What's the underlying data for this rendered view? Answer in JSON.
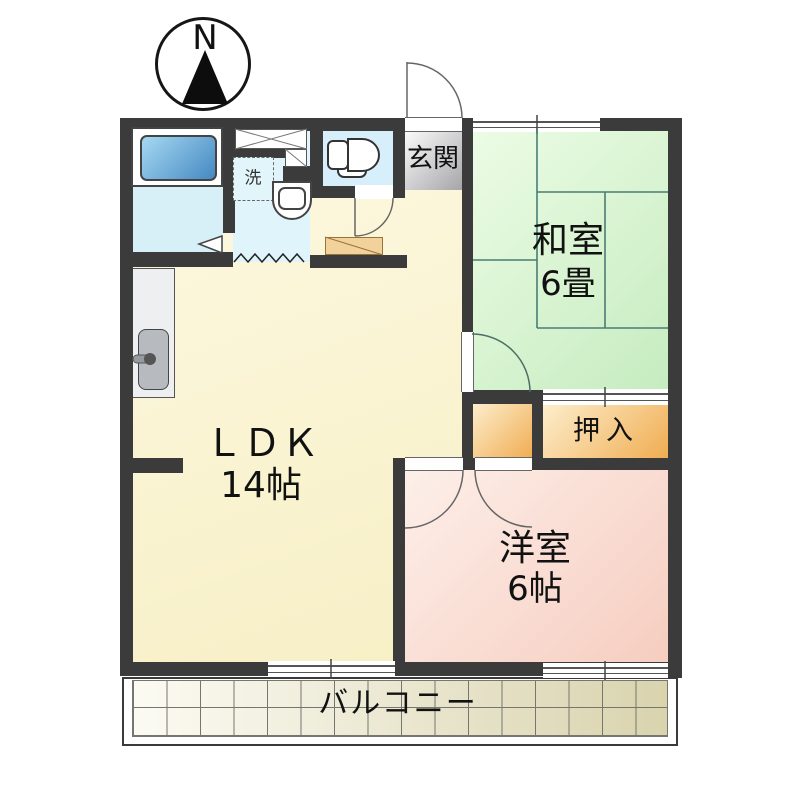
{
  "title": "apartment floor plan",
  "compass": {
    "label": "N"
  },
  "rooms": {
    "genkan": {
      "label": "玄関"
    },
    "washitsu": {
      "label": "和室",
      "size": "6畳"
    },
    "ldk": {
      "label": "ＬＤＫ",
      "size": "14帖"
    },
    "oshiire": {
      "label": "押入"
    },
    "youshitsu": {
      "label": "洋室",
      "size": "6帖"
    },
    "balcony": {
      "label": "バルコニー"
    },
    "laundry": {
      "label": "洗"
    }
  },
  "colors": {
    "wall": "#3b3b3b",
    "tatami_green": "#d4f0cb",
    "ldk_cream": "#faf3cf",
    "western_pink": "#f8d5c8",
    "closet_orange": "#f0ad52",
    "water_blue": "#d9f1f9",
    "tub_blue": "#4588c2",
    "genkan_gray": "#a6a6aa",
    "balcony_beige": "#d9d3ae"
  }
}
